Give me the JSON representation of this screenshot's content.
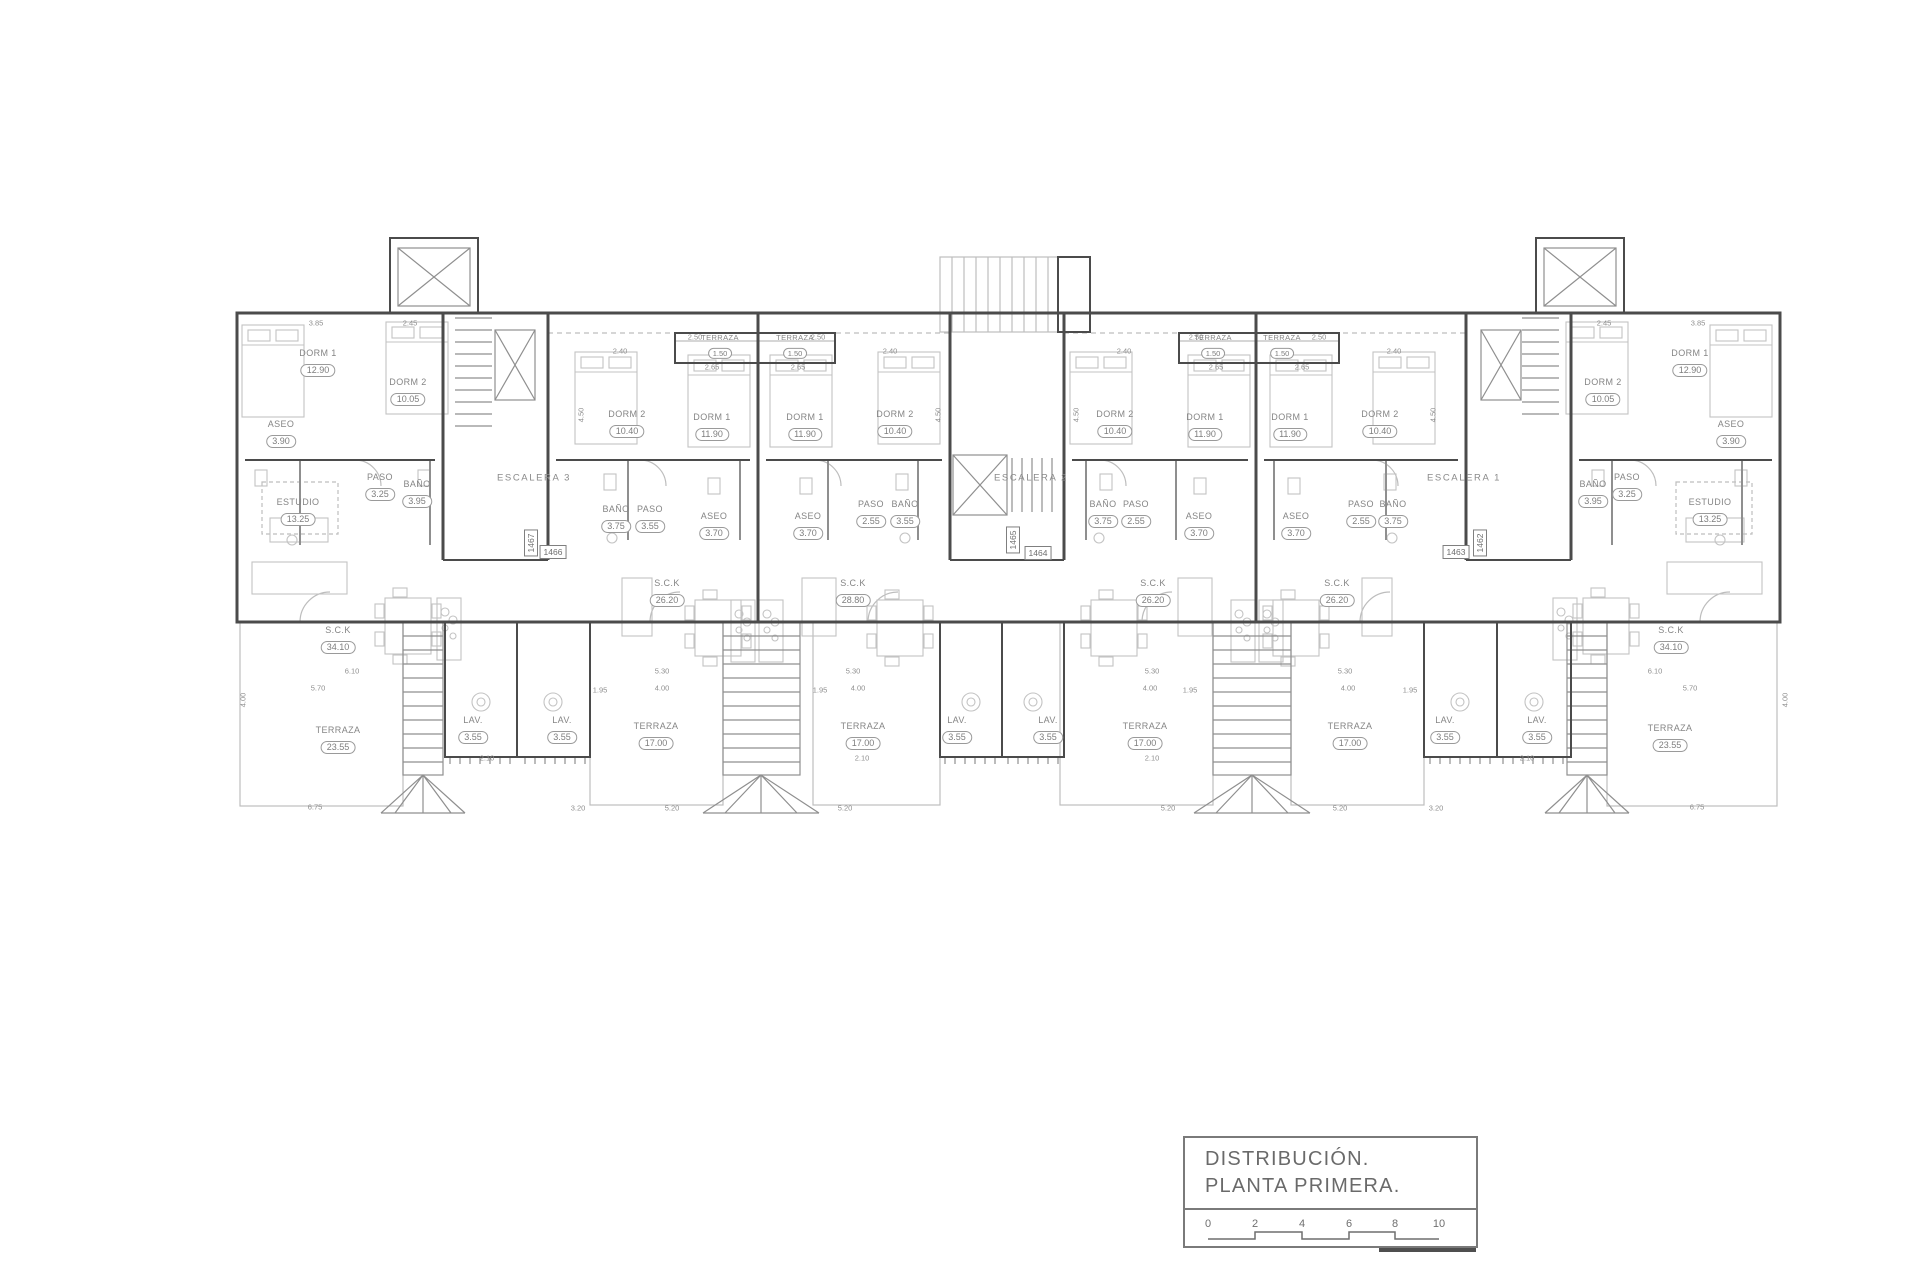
{
  "sheet": {
    "background": "#ffffff",
    "wall_color": "#4b4b4b",
    "light_line_color": "#bdbdbd",
    "label_color": "#858585"
  },
  "title_block": {
    "line1": "DISTRIBUCIÓN.",
    "line2": "PLANTA  PRIMERA.",
    "scale_ticks": [
      "0",
      "2",
      "4",
      "6",
      "8",
      "10"
    ]
  },
  "stair_labels": [
    {
      "text": "ESCALERA 3",
      "x": 534,
      "y": 478
    },
    {
      "text": "ESCALERA 2",
      "x": 1031,
      "y": 478
    },
    {
      "text": "ESCALERA 1",
      "x": 1464,
      "y": 478
    }
  ],
  "unit_tags": [
    {
      "text": "1467",
      "x": 531,
      "y": 543,
      "vertical": true
    },
    {
      "text": "1466",
      "x": 553,
      "y": 552
    },
    {
      "text": "1465",
      "x": 1013,
      "y": 540,
      "vertical": true
    },
    {
      "text": "1464",
      "x": 1038,
      "y": 553
    },
    {
      "text": "1463",
      "x": 1456,
      "y": 552
    },
    {
      "text": "1462",
      "x": 1480,
      "y": 543,
      "vertical": true
    }
  ],
  "rooms": [
    {
      "name": "DORM 1",
      "area": "12.90",
      "x": 318,
      "y": 363
    },
    {
      "name": "DORM 2",
      "area": "10.05",
      "x": 408,
      "y": 392
    },
    {
      "name": "ASEO",
      "area": "3.90",
      "x": 281,
      "y": 434
    },
    {
      "name": "PASO",
      "area": "3.25",
      "x": 380,
      "y": 487
    },
    {
      "name": "BAÑO",
      "area": "3.95",
      "x": 417,
      "y": 494
    },
    {
      "name": "ESTUDIO",
      "area": "13.25",
      "x": 298,
      "y": 512
    },
    {
      "name": "S.C.K",
      "area": "34.10",
      "x": 338,
      "y": 640
    },
    {
      "name": "TERRAZA",
      "area": "23.55",
      "x": 338,
      "y": 740
    },
    {
      "name": "LAV.",
      "area": "3.55",
      "x": 473,
      "y": 730
    },
    {
      "name": "TERRAZA",
      "area": "1.50",
      "x": 720,
      "y": 347,
      "small": true
    },
    {
      "name": "DORM 2",
      "area": "10.40",
      "x": 627,
      "y": 424
    },
    {
      "name": "DORM 1",
      "area": "11.90",
      "x": 712,
      "y": 427
    },
    {
      "name": "BAÑO",
      "area": "3.75",
      "x": 616,
      "y": 519
    },
    {
      "name": "PASO",
      "area": "3.55",
      "x": 650,
      "y": 519
    },
    {
      "name": "ASEO",
      "area": "3.70",
      "x": 714,
      "y": 526
    },
    {
      "name": "S.C.K",
      "area": "26.20",
      "x": 667,
      "y": 593
    },
    {
      "name": "LAV.",
      "area": "3.55",
      "x": 562,
      "y": 730
    },
    {
      "name": "TERRAZA",
      "area": "17.00",
      "x": 656,
      "y": 736
    },
    {
      "name": "TERRAZA",
      "area": "1.50",
      "x": 795,
      "y": 347,
      "small": true
    },
    {
      "name": "DORM 1",
      "area": "11.90",
      "x": 805,
      "y": 427
    },
    {
      "name": "DORM 2",
      "area": "10.40",
      "x": 895,
      "y": 424
    },
    {
      "name": "ASEO",
      "area": "3.70",
      "x": 808,
      "y": 526
    },
    {
      "name": "PASO",
      "area": "2.55",
      "x": 871,
      "y": 514
    },
    {
      "name": "BAÑO",
      "area": "3.55",
      "x": 905,
      "y": 514
    },
    {
      "name": "S.C.K",
      "area": "28.80",
      "x": 853,
      "y": 593
    },
    {
      "name": "LAV.",
      "area": "3.55",
      "x": 957,
      "y": 730
    },
    {
      "name": "TERRAZA",
      "area": "17.00",
      "x": 863,
      "y": 736
    },
    {
      "name": "DORM 2",
      "area": "10.40",
      "x": 1115,
      "y": 424
    },
    {
      "name": "DORM 1",
      "area": "11.90",
      "x": 1205,
      "y": 427
    },
    {
      "name": "TERRAZA",
      "area": "1.50",
      "x": 1213,
      "y": 347,
      "small": true
    },
    {
      "name": "BAÑO",
      "area": "3.75",
      "x": 1103,
      "y": 514
    },
    {
      "name": "PASO",
      "area": "2.55",
      "x": 1136,
      "y": 514
    },
    {
      "name": "ASEO",
      "area": "3.70",
      "x": 1199,
      "y": 526
    },
    {
      "name": "S.C.K",
      "area": "26.20",
      "x": 1153,
      "y": 593
    },
    {
      "name": "LAV.",
      "area": "3.55",
      "x": 1048,
      "y": 730
    },
    {
      "name": "TERRAZA",
      "area": "17.00",
      "x": 1145,
      "y": 736
    },
    {
      "name": "TERRAZA",
      "area": "1.50",
      "x": 1282,
      "y": 347,
      "small": true
    },
    {
      "name": "DORM 1",
      "area": "11.90",
      "x": 1290,
      "y": 427
    },
    {
      "name": "DORM 2",
      "area": "10.40",
      "x": 1380,
      "y": 424
    },
    {
      "name": "ASEO",
      "area": "3.70",
      "x": 1296,
      "y": 526
    },
    {
      "name": "PASO",
      "area": "2.55",
      "x": 1361,
      "y": 514
    },
    {
      "name": "BAÑO",
      "area": "3.75",
      "x": 1393,
      "y": 514
    },
    {
      "name": "S.C.K",
      "area": "26.20",
      "x": 1337,
      "y": 593
    },
    {
      "name": "LAV.",
      "area": "3.55",
      "x": 1445,
      "y": 730
    },
    {
      "name": "TERRAZA",
      "area": "17.00",
      "x": 1350,
      "y": 736
    },
    {
      "name": "DORM 2",
      "area": "10.05",
      "x": 1603,
      "y": 392
    },
    {
      "name": "DORM 1",
      "area": "12.90",
      "x": 1690,
      "y": 363
    },
    {
      "name": "ASEO",
      "area": "3.90",
      "x": 1731,
      "y": 434
    },
    {
      "name": "BAÑO",
      "area": "3.95",
      "x": 1593,
      "y": 494
    },
    {
      "name": "PASO",
      "area": "3.25",
      "x": 1627,
      "y": 487
    },
    {
      "name": "ESTUDIO",
      "area": "13.25",
      "x": 1710,
      "y": 512
    },
    {
      "name": "S.C.K",
      "area": "34.10",
      "x": 1671,
      "y": 640
    },
    {
      "name": "TERRAZA",
      "area": "23.55",
      "x": 1670,
      "y": 738
    },
    {
      "name": "LAV.",
      "area": "3.55",
      "x": 1537,
      "y": 730
    }
  ],
  "dimensions": [
    {
      "t": "3.85",
      "x": 316,
      "y": 323
    },
    {
      "t": "2.45",
      "x": 410,
      "y": 323
    },
    {
      "t": "2.40",
      "x": 620,
      "y": 351
    },
    {
      "t": "2.50",
      "x": 695,
      "y": 337
    },
    {
      "t": "2.65",
      "x": 712,
      "y": 367
    },
    {
      "t": "2.65",
      "x": 798,
      "y": 367
    },
    {
      "t": "2.50",
      "x": 818,
      "y": 337
    },
    {
      "t": "2.40",
      "x": 890,
      "y": 351
    },
    {
      "t": "2.40",
      "x": 1124,
      "y": 351
    },
    {
      "t": "2.50",
      "x": 1196,
      "y": 337
    },
    {
      "t": "2.65",
      "x": 1216,
      "y": 367
    },
    {
      "t": "2.65",
      "x": 1302,
      "y": 367
    },
    {
      "t": "2.50",
      "x": 1319,
      "y": 337
    },
    {
      "t": "2.40",
      "x": 1394,
      "y": 351
    },
    {
      "t": "2.45",
      "x": 1604,
      "y": 323
    },
    {
      "t": "3.85",
      "x": 1698,
      "y": 323
    },
    {
      "t": "4.50",
      "x": 581,
      "y": 415,
      "v": true
    },
    {
      "t": "4.50",
      "x": 938,
      "y": 415,
      "v": true
    },
    {
      "t": "4.50",
      "x": 1076,
      "y": 415,
      "v": true
    },
    {
      "t": "4.50",
      "x": 1433,
      "y": 415,
      "v": true
    },
    {
      "t": "6.10",
      "x": 352,
      "y": 671
    },
    {
      "t": "5.70",
      "x": 318,
      "y": 688
    },
    {
      "t": "5.30",
      "x": 662,
      "y": 671
    },
    {
      "t": "4.00",
      "x": 662,
      "y": 688
    },
    {
      "t": "5.30",
      "x": 853,
      "y": 671
    },
    {
      "t": "4.00",
      "x": 858,
      "y": 688
    },
    {
      "t": "5.30",
      "x": 1152,
      "y": 671
    },
    {
      "t": "4.00",
      "x": 1150,
      "y": 688
    },
    {
      "t": "5.30",
      "x": 1345,
      "y": 671
    },
    {
      "t": "4.00",
      "x": 1348,
      "y": 688
    },
    {
      "t": "6.10",
      "x": 1655,
      "y": 671
    },
    {
      "t": "5.70",
      "x": 1690,
      "y": 688
    },
    {
      "t": "1.95",
      "x": 600,
      "y": 690
    },
    {
      "t": "1.95",
      "x": 820,
      "y": 690
    },
    {
      "t": "1.95",
      "x": 1190,
      "y": 690
    },
    {
      "t": "1.95",
      "x": 1410,
      "y": 690
    },
    {
      "t": "2.10",
      "x": 487,
      "y": 758
    },
    {
      "t": "2.10",
      "x": 862,
      "y": 758
    },
    {
      "t": "2.10",
      "x": 1152,
      "y": 758
    },
    {
      "t": "2.10",
      "x": 1527,
      "y": 758
    },
    {
      "t": "6.75",
      "x": 315,
      "y": 807
    },
    {
      "t": "3.20",
      "x": 578,
      "y": 808
    },
    {
      "t": "5.20",
      "x": 672,
      "y": 808
    },
    {
      "t": "5.20",
      "x": 845,
      "y": 808
    },
    {
      "t": "5.20",
      "x": 1168,
      "y": 808
    },
    {
      "t": "5.20",
      "x": 1340,
      "y": 808
    },
    {
      "t": "3.20",
      "x": 1436,
      "y": 808
    },
    {
      "t": "6.75",
      "x": 1697,
      "y": 807
    },
    {
      "t": "4.00",
      "x": 243,
      "y": 700,
      "v": true
    },
    {
      "t": "4.00",
      "x": 1785,
      "y": 700,
      "v": true
    }
  ]
}
